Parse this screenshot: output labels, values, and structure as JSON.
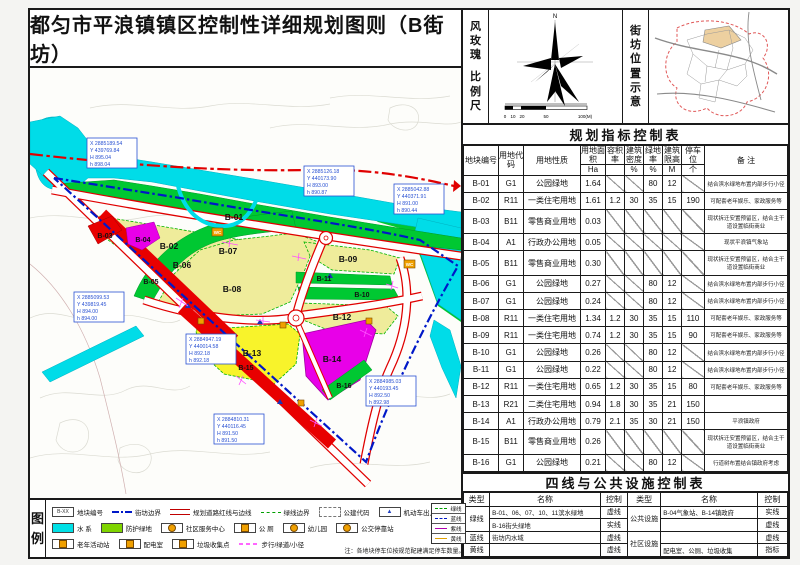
{
  "sheet_title": "都匀市平浪镇镇区控制性详细规划图则（B街坊）",
  "panel_labels": {
    "wind_rose": "风玫瑰",
    "scale": "比例尺",
    "location": "街坊位置示意"
  },
  "windrose": {
    "north": "N",
    "scale_ticks": [
      "0",
      "10",
      "20",
      "50",
      "100(M)"
    ]
  },
  "indicator_table": {
    "title": "规划指标控制表",
    "headers": {
      "plot": "地块编号",
      "code": "用地代码",
      "nature": "用地性质",
      "area": "用地面积",
      "far": "容积率",
      "density": "建筑密度",
      "green": "绿地率",
      "height": "建筑限高",
      "parking": "停车位",
      "remark": "备 注"
    },
    "units": {
      "area": "Ha",
      "far": "",
      "density": "%",
      "green": "%",
      "height": "M",
      "parking": "个"
    },
    "rows": [
      {
        "plot": "B-01",
        "code": "G1",
        "nature": "公园绿地",
        "area": "1.64",
        "far": "",
        "density": "",
        "green": "80",
        "height": "12",
        "parking": "",
        "remark": "结合滨水绿地布置内部步行小径"
      },
      {
        "plot": "B-02",
        "code": "R11",
        "nature": "一类住宅用地",
        "area": "1.61",
        "far": "1.2",
        "density": "30",
        "green": "35",
        "height": "15",
        "parking": "190",
        "remark": "可配套老年娱乐、家政服务等"
      },
      {
        "plot": "B-03",
        "code": "B11",
        "nature": "零售商业用地",
        "area": "0.03",
        "far": "",
        "density": "",
        "green": "",
        "height": "",
        "parking": "",
        "remark": "现状拆迁安置预留区，结合主干道设置临街商业"
      },
      {
        "plot": "B-04",
        "code": "A1",
        "nature": "行政办公用地",
        "area": "0.05",
        "far": "",
        "density": "",
        "green": "",
        "height": "",
        "parking": "",
        "remark": "现状平浪镇气象站"
      },
      {
        "plot": "B-05",
        "code": "B11",
        "nature": "零售商业用地",
        "area": "0.30",
        "far": "",
        "density": "",
        "green": "",
        "height": "",
        "parking": "",
        "remark": "现状拆迁安置预留区，结合主干道设置临街商业"
      },
      {
        "plot": "B-06",
        "code": "G1",
        "nature": "公园绿地",
        "area": "0.27",
        "far": "",
        "density": "",
        "green": "80",
        "height": "12",
        "parking": "",
        "remark": "结合滨水绿地布置内部步行小径"
      },
      {
        "plot": "B-07",
        "code": "G1",
        "nature": "公园绿地",
        "area": "0.24",
        "far": "",
        "density": "",
        "green": "80",
        "height": "12",
        "parking": "",
        "remark": "结合滨水绿地布置内部步行小径"
      },
      {
        "plot": "B-08",
        "code": "R11",
        "nature": "一类住宅用地",
        "area": "1.34",
        "far": "1.2",
        "density": "30",
        "green": "35",
        "height": "15",
        "parking": "110",
        "remark": "可配套老年娱乐、家政服务等"
      },
      {
        "plot": "B-09",
        "code": "R11",
        "nature": "一类住宅用地",
        "area": "0.74",
        "far": "1.2",
        "density": "30",
        "green": "35",
        "height": "15",
        "parking": "90",
        "remark": "可配套老年娱乐、家政服务等"
      },
      {
        "plot": "B-10",
        "code": "G1",
        "nature": "公园绿地",
        "area": "0.26",
        "far": "",
        "density": "",
        "green": "80",
        "height": "12",
        "parking": "",
        "remark": "结合滨水绿地布置内部步行小径"
      },
      {
        "plot": "B-11",
        "code": "G1",
        "nature": "公园绿地",
        "area": "0.22",
        "far": "",
        "density": "",
        "green": "80",
        "height": "12",
        "parking": "",
        "remark": "结合滨水绿地布置内部步行小径"
      },
      {
        "plot": "B-12",
        "code": "R11",
        "nature": "一类住宅用地",
        "area": "0.65",
        "far": "1.2",
        "density": "30",
        "green": "35",
        "height": "15",
        "parking": "80",
        "remark": "可配套老年娱乐、家政服务等"
      },
      {
        "plot": "B-13",
        "code": "R21",
        "nature": "二类住宅用地",
        "area": "0.94",
        "far": "1.8",
        "density": "30",
        "green": "35",
        "height": "21",
        "parking": "150",
        "remark": ""
      },
      {
        "plot": "B-14",
        "code": "A1",
        "nature": "行政办公用地",
        "area": "0.79",
        "far": "2.1",
        "density": "35",
        "green": "30",
        "height": "21",
        "parking": "150",
        "remark": "平浪镇政府"
      },
      {
        "plot": "B-15",
        "code": "B11",
        "nature": "零售商业用地",
        "area": "0.26",
        "far": "",
        "density": "",
        "green": "",
        "height": "",
        "parking": "",
        "remark": "现状拆迁安置预留区，结合主干道设置临街商业"
      },
      {
        "plot": "B-16",
        "code": "G1",
        "nature": "公园绿地",
        "area": "0.21",
        "far": "",
        "density": "",
        "green": "80",
        "height": "12",
        "parking": "",
        "remark": "行道树布置结合镇政府考虑"
      }
    ]
  },
  "lines_table": {
    "title": "四线与公共设施控制表",
    "col_type": "类型",
    "col_name": "名称",
    "col_ctrl": "控制",
    "green_label": "绿线",
    "blue_label": "蓝线",
    "yellow_label": "黄线",
    "public_label": "公共设施",
    "community_label": "社区设施",
    "rows_left": [
      {
        "name": "B-01、06、07、10、11滨水绿地",
        "ctrl": "虚线"
      },
      {
        "name": "B-16街头绿地",
        "ctrl": "实线"
      },
      {
        "name": "街坊内水域",
        "ctrl": "虚线"
      },
      {
        "name": "",
        "ctrl": "虚线"
      }
    ],
    "rows_right": [
      {
        "name": "B-04气象站、B-14镇政府",
        "ctrl": "实线"
      },
      {
        "name": "",
        "ctrl": "虚线"
      },
      {
        "name": "",
        "ctrl": "虚线"
      },
      {
        "name": "配电室、公厕、垃圾收集",
        "ctrl": "指标"
      }
    ]
  },
  "legend": {
    "title": "图例",
    "plot_swatch": "B-XX",
    "entrance_glyph": "▲",
    "row1": [
      "地块编号",
      "街坊边界",
      "规划道路红线与边线",
      "绿线边界",
      "公建代码",
      "机动车出入口示意"
    ],
    "row2": [
      "水  系",
      "防护绿地",
      "社区服务中心",
      "公  厕",
      "幼儿园",
      "公交停靠站"
    ],
    "row3": [
      "老年活动站",
      "配电室",
      "垃圾收集点",
      "步行/绿道/小径"
    ],
    "four_lines": [
      "绿线",
      "蓝线",
      "紫线",
      "黄线"
    ],
    "note": "注：各地块停车位按规范配建满足停车数量。"
  },
  "map": {
    "wc_label": "WC",
    "plot_labels": [
      "B-01",
      "B-02",
      "B-03",
      "B-04",
      "B-05",
      "B-06",
      "B-07",
      "B-08",
      "B-09",
      "B-10",
      "B-11",
      "B-12",
      "B-13",
      "B-14",
      "B-15",
      "B-16"
    ],
    "coord_boxes": [
      {
        "l1": "X 2885189.54",
        "l2": "Y 439769.84",
        "l3": "H 895.04",
        "l4": "h 898.04"
      },
      {
        "l1": "X 2885126.18",
        "l2": "Y 440173.90",
        "l3": "H 893.00",
        "l4": "h 890.87"
      },
      {
        "l1": "X 2885042.88",
        "l2": "Y 440371.91",
        "l3": "H 891.00",
        "l4": "h 890.44"
      },
      {
        "l1": "X 2885099.53",
        "l2": "Y 439819.45",
        "l3": "H 894.00",
        "l4": "h 894.00"
      },
      {
        "l1": "X 2884947.19",
        "l2": "Y 440014.58",
        "l3": "H 892.18",
        "l4": "h 892.18"
      },
      {
        "l1": "X 2884985.03",
        "l2": "Y 440193.45",
        "l3": "H 892.50",
        "l4": "h 892.98"
      },
      {
        "l1": "X 2884810.31",
        "l2": "Y 440116.45",
        "l3": "H 891.50",
        "l4": "h 891.50"
      }
    ]
  }
}
